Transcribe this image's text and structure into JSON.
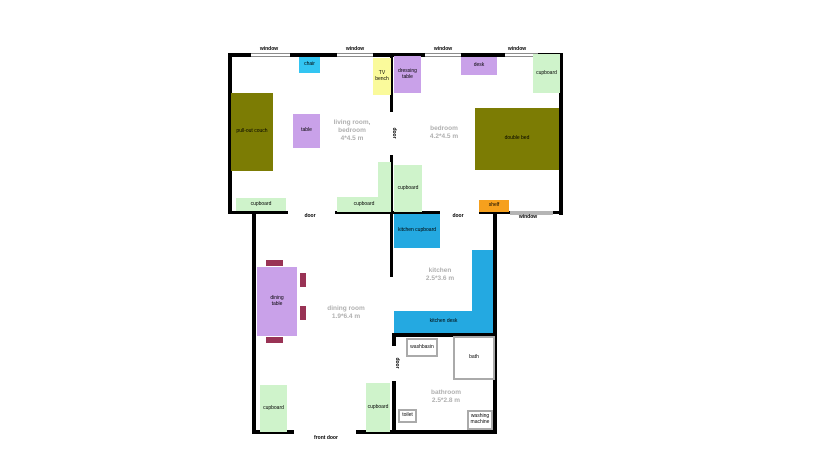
{
  "labels": {
    "window": "window",
    "door": "door",
    "front_door": "front door"
  },
  "rooms": {
    "living": {
      "line1": "living room,",
      "line2": "bedroom",
      "line3": "4*4.5 m"
    },
    "bedroom": {
      "line1": "bedroom",
      "line2": "4.2*4.5 m"
    },
    "kitchen": {
      "line1": "kitchen",
      "line2": "2.5*3.6 m"
    },
    "dining": {
      "line1": "dining room",
      "line2": "1.9*6.4 m"
    },
    "bathroom": {
      "line1": "bathroom",
      "line2": "2.5*2.8 m"
    }
  },
  "furniture": {
    "chair": "chair",
    "tv_bench": "TV bench",
    "dressing_table": "dressing table",
    "desk": "desk",
    "cupboard": "cupboard",
    "pull_out_couch": "pull-out couch",
    "table": "table",
    "double_bed": "double bed",
    "shelf": "shelf",
    "kitchen_cupboard": "kitchen cupboard",
    "kitchen_desk": "kitchen desk",
    "dining_table": "dining table",
    "washbasin": "washbasin",
    "bath": "bath",
    "toilet": "toilet",
    "washing_machine": "washing machine"
  },
  "colors": {
    "wall": "#000000",
    "window_glass": "#b5b5b5",
    "chair_cyan": "#33c5f2",
    "furniture_purple": "#c9a1e9",
    "tv_bench_yellow": "#fafa9b",
    "cupboard_green": "#cff3cb",
    "bed_olive": "#7c7c04",
    "shelf_orange": "#f6a01d",
    "kitchen_blue": "#24a9e1",
    "dining_chair_maroon": "#993355",
    "room_text_gray": "#b0b0b0",
    "fixture_border_gray": "#aaaaaa"
  }
}
